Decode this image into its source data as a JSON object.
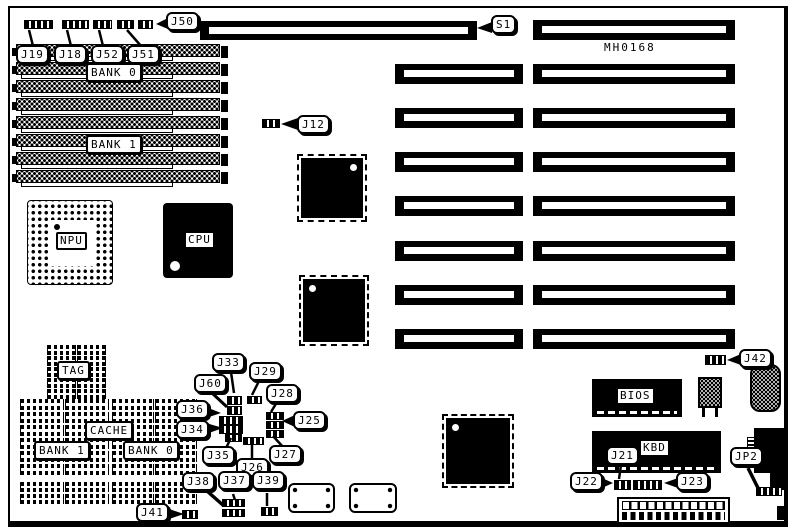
{
  "board": {
    "model": "MH0168"
  },
  "chips": {
    "npu": "NPU",
    "cpu": "CPU",
    "bios": "BIOS",
    "kbd": "KBD"
  },
  "simm": {
    "bank0": "BANK 0",
    "bank1": "BANK 1"
  },
  "cache": {
    "tag": "TAG",
    "cache": "CACHE",
    "bank1": "BANK 1",
    "bank0": "BANK 0"
  },
  "jumpers": {
    "j50": "J50",
    "s1": "S1",
    "j19": "J19",
    "j18": "J18",
    "j52": "J52",
    "j51": "J51",
    "j12": "J12",
    "j42": "J42",
    "j33": "J33",
    "j29": "J29",
    "j60": "J60",
    "j28": "J28",
    "j36": "J36",
    "j34": "J34",
    "j25": "J25",
    "j35": "J35",
    "j26": "J26",
    "j27": "J27",
    "j38": "J38",
    "j37": "J37",
    "j39": "J39",
    "j41": "J41",
    "j22": "J22",
    "j21": "J21",
    "j23": "J23",
    "jp2": "JP2"
  }
}
